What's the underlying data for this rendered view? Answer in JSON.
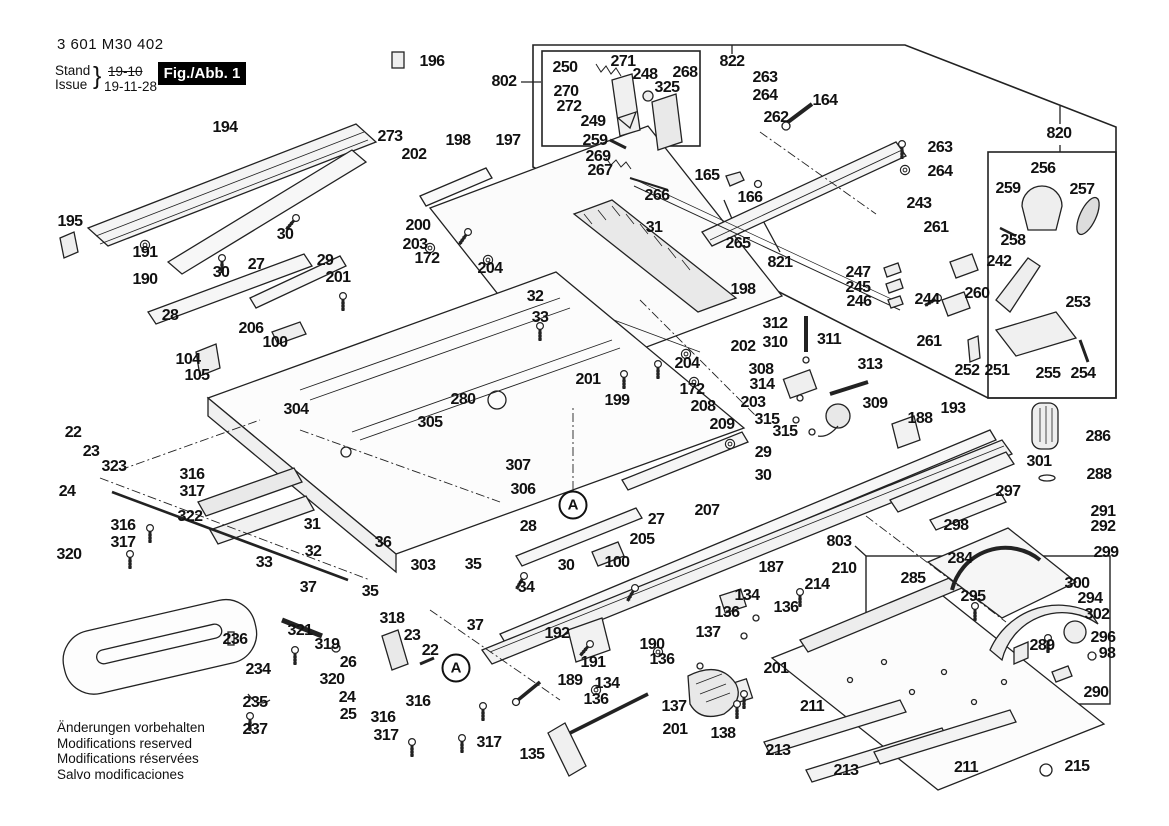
{
  "header": {
    "part_number": "3 601 M30 402",
    "stand_label": "Stand",
    "issue_label": "Issue",
    "brace": "}",
    "stand_value": "19-10",
    "issue_value": "19-11-28",
    "fig_label": "Fig./Abb. 1"
  },
  "footer": {
    "lines": [
      "Änderungen vorbehalten",
      "Modifications reserved",
      "Modifications réservées",
      "Salvo modificaciones"
    ]
  },
  "colors": {
    "ink": "#1a1a1a",
    "fig_box_bg": "#000000",
    "fig_box_text": "#ffffff",
    "paper": "#ffffff"
  },
  "circled_callouts": [
    {
      "t": "A",
      "x": 573,
      "y": 505
    },
    {
      "t": "A",
      "x": 456,
      "y": 668
    }
  ],
  "part_labels": [
    {
      "t": "196",
      "x": 432,
      "y": 62
    },
    {
      "t": "194",
      "x": 225,
      "y": 128
    },
    {
      "t": "273",
      "x": 390,
      "y": 137
    },
    {
      "t": "198",
      "x": 458,
      "y": 141
    },
    {
      "t": "202",
      "x": 414,
      "y": 155
    },
    {
      "t": "197",
      "x": 508,
      "y": 141
    },
    {
      "t": "195",
      "x": 70,
      "y": 222
    },
    {
      "t": "191",
      "x": 145,
      "y": 253
    },
    {
      "t": "190",
      "x": 145,
      "y": 280
    },
    {
      "t": "30",
      "x": 285,
      "y": 235
    },
    {
      "t": "30",
      "x": 221,
      "y": 273
    },
    {
      "t": "29",
      "x": 325,
      "y": 261
    },
    {
      "t": "27",
      "x": 256,
      "y": 265
    },
    {
      "t": "201",
      "x": 338,
      "y": 278
    },
    {
      "t": "28",
      "x": 170,
      "y": 316
    },
    {
      "t": "200",
      "x": 418,
      "y": 226
    },
    {
      "t": "203",
      "x": 415,
      "y": 245
    },
    {
      "t": "172",
      "x": 427,
      "y": 259
    },
    {
      "t": "204",
      "x": 490,
      "y": 269
    },
    {
      "t": "206",
      "x": 251,
      "y": 329
    },
    {
      "t": "100",
      "x": 275,
      "y": 343
    },
    {
      "t": "104",
      "x": 188,
      "y": 360
    },
    {
      "t": "105",
      "x": 197,
      "y": 376
    },
    {
      "t": "31",
      "x": 654,
      "y": 228
    },
    {
      "t": "32",
      "x": 535,
      "y": 297
    },
    {
      "t": "33",
      "x": 540,
      "y": 318
    },
    {
      "t": "802",
      "x": 504,
      "y": 82
    },
    {
      "t": "250",
      "x": 565,
      "y": 68
    },
    {
      "t": "271",
      "x": 623,
      "y": 62
    },
    {
      "t": "248",
      "x": 645,
      "y": 75
    },
    {
      "t": "268",
      "x": 685,
      "y": 73
    },
    {
      "t": "325",
      "x": 667,
      "y": 88
    },
    {
      "t": "270",
      "x": 566,
      "y": 92
    },
    {
      "t": "272",
      "x": 569,
      "y": 107
    },
    {
      "t": "249",
      "x": 593,
      "y": 122
    },
    {
      "t": "259",
      "x": 595,
      "y": 141
    },
    {
      "t": "269",
      "x": 598,
      "y": 157
    },
    {
      "t": "267",
      "x": 600,
      "y": 171
    },
    {
      "t": "266",
      "x": 657,
      "y": 196
    },
    {
      "t": "165",
      "x": 707,
      "y": 176
    },
    {
      "t": "166",
      "x": 750,
      "y": 198
    },
    {
      "t": "822",
      "x": 732,
      "y": 62
    },
    {
      "t": "263",
      "x": 765,
      "y": 78
    },
    {
      "t": "264",
      "x": 765,
      "y": 96
    },
    {
      "t": "262",
      "x": 776,
      "y": 118
    },
    {
      "t": "164",
      "x": 825,
      "y": 101
    },
    {
      "t": "265",
      "x": 738,
      "y": 244
    },
    {
      "t": "821",
      "x": 780,
      "y": 263
    },
    {
      "t": "820",
      "x": 1059,
      "y": 134
    },
    {
      "t": "263",
      "x": 940,
      "y": 148
    },
    {
      "t": "264",
      "x": 940,
      "y": 172
    },
    {
      "t": "243",
      "x": 919,
      "y": 204
    },
    {
      "t": "261",
      "x": 936,
      "y": 228
    },
    {
      "t": "256",
      "x": 1043,
      "y": 169
    },
    {
      "t": "259",
      "x": 1008,
      "y": 189
    },
    {
      "t": "257",
      "x": 1082,
      "y": 190
    },
    {
      "t": "258",
      "x": 1013,
      "y": 241
    },
    {
      "t": "242",
      "x": 999,
      "y": 262
    },
    {
      "t": "260",
      "x": 977,
      "y": 294
    },
    {
      "t": "244",
      "x": 927,
      "y": 300
    },
    {
      "t": "261",
      "x": 929,
      "y": 342
    },
    {
      "t": "253",
      "x": 1078,
      "y": 303
    },
    {
      "t": "252",
      "x": 967,
      "y": 371
    },
    {
      "t": "251",
      "x": 997,
      "y": 371
    },
    {
      "t": "255",
      "x": 1048,
      "y": 374
    },
    {
      "t": "254",
      "x": 1083,
      "y": 374
    },
    {
      "t": "247",
      "x": 858,
      "y": 273
    },
    {
      "t": "245",
      "x": 858,
      "y": 288
    },
    {
      "t": "246",
      "x": 859,
      "y": 302
    },
    {
      "t": "304",
      "x": 296,
      "y": 410
    },
    {
      "t": "280",
      "x": 463,
      "y": 400
    },
    {
      "t": "305",
      "x": 430,
      "y": 423
    },
    {
      "t": "307",
      "x": 518,
      "y": 466
    },
    {
      "t": "306",
      "x": 523,
      "y": 490
    },
    {
      "t": "198",
      "x": 743,
      "y": 290
    },
    {
      "t": "202",
      "x": 743,
      "y": 347
    },
    {
      "t": "201",
      "x": 588,
      "y": 380
    },
    {
      "t": "199",
      "x": 617,
      "y": 401
    },
    {
      "t": "204",
      "x": 687,
      "y": 364
    },
    {
      "t": "172",
      "x": 692,
      "y": 390
    },
    {
      "t": "203",
      "x": 753,
      "y": 403
    },
    {
      "t": "208",
      "x": 703,
      "y": 407
    },
    {
      "t": "209",
      "x": 722,
      "y": 425
    },
    {
      "t": "312",
      "x": 775,
      "y": 324
    },
    {
      "t": "310",
      "x": 775,
      "y": 343
    },
    {
      "t": "311",
      "x": 829,
      "y": 340
    },
    {
      "t": "308",
      "x": 761,
      "y": 370
    },
    {
      "t": "314",
      "x": 762,
      "y": 385
    },
    {
      "t": "313",
      "x": 870,
      "y": 365
    },
    {
      "t": "309",
      "x": 875,
      "y": 404
    },
    {
      "t": "315",
      "x": 767,
      "y": 420
    },
    {
      "t": "315",
      "x": 785,
      "y": 432
    },
    {
      "t": "188",
      "x": 920,
      "y": 419
    },
    {
      "t": "193",
      "x": 953,
      "y": 409
    },
    {
      "t": "29",
      "x": 763,
      "y": 453
    },
    {
      "t": "30",
      "x": 763,
      "y": 476
    },
    {
      "t": "27",
      "x": 656,
      "y": 520
    },
    {
      "t": "207",
      "x": 707,
      "y": 511
    },
    {
      "t": "205",
      "x": 642,
      "y": 540
    },
    {
      "t": "100",
      "x": 617,
      "y": 563
    },
    {
      "t": "30",
      "x": 566,
      "y": 566
    },
    {
      "t": "28",
      "x": 528,
      "y": 527
    },
    {
      "t": "187",
      "x": 771,
      "y": 568
    },
    {
      "t": "22",
      "x": 73,
      "y": 433
    },
    {
      "t": "23",
      "x": 91,
      "y": 452
    },
    {
      "t": "323",
      "x": 114,
      "y": 467
    },
    {
      "t": "316",
      "x": 192,
      "y": 475
    },
    {
      "t": "317",
      "x": 192,
      "y": 492
    },
    {
      "t": "24",
      "x": 67,
      "y": 492
    },
    {
      "t": "316",
      "x": 123,
      "y": 526
    },
    {
      "t": "317",
      "x": 123,
      "y": 543
    },
    {
      "t": "320",
      "x": 69,
      "y": 555
    },
    {
      "t": "322",
      "x": 190,
      "y": 517
    },
    {
      "t": "31",
      "x": 312,
      "y": 525
    },
    {
      "t": "32",
      "x": 313,
      "y": 552
    },
    {
      "t": "33",
      "x": 264,
      "y": 563
    },
    {
      "t": "36",
      "x": 383,
      "y": 543
    },
    {
      "t": "35",
      "x": 370,
      "y": 592
    },
    {
      "t": "37",
      "x": 308,
      "y": 588
    },
    {
      "t": "303",
      "x": 423,
      "y": 566
    },
    {
      "t": "35",
      "x": 473,
      "y": 565
    },
    {
      "t": "34",
      "x": 526,
      "y": 588
    },
    {
      "t": "37",
      "x": 475,
      "y": 626
    },
    {
      "t": "318",
      "x": 392,
      "y": 619
    },
    {
      "t": "23",
      "x": 412,
      "y": 636
    },
    {
      "t": "22",
      "x": 430,
      "y": 651
    },
    {
      "t": "321",
      "x": 300,
      "y": 631
    },
    {
      "t": "319",
      "x": 327,
      "y": 645
    },
    {
      "t": "26",
      "x": 348,
      "y": 663
    },
    {
      "t": "320",
      "x": 332,
      "y": 680
    },
    {
      "t": "24",
      "x": 347,
      "y": 698
    },
    {
      "t": "25",
      "x": 348,
      "y": 715
    },
    {
      "t": "316",
      "x": 383,
      "y": 718
    },
    {
      "t": "317",
      "x": 386,
      "y": 736
    },
    {
      "t": "236",
      "x": 235,
      "y": 640
    },
    {
      "t": "234",
      "x": 258,
      "y": 670
    },
    {
      "t": "235",
      "x": 255,
      "y": 703
    },
    {
      "t": "237",
      "x": 255,
      "y": 730
    },
    {
      "t": "192",
      "x": 557,
      "y": 634
    },
    {
      "t": "190",
      "x": 652,
      "y": 645
    },
    {
      "t": "191",
      "x": 593,
      "y": 663
    },
    {
      "t": "189",
      "x": 570,
      "y": 681
    },
    {
      "t": "134",
      "x": 747,
      "y": 596
    },
    {
      "t": "136",
      "x": 727,
      "y": 613
    },
    {
      "t": "137",
      "x": 708,
      "y": 633
    },
    {
      "t": "136",
      "x": 662,
      "y": 660
    },
    {
      "t": "134",
      "x": 607,
      "y": 684
    },
    {
      "t": "136",
      "x": 596,
      "y": 700
    },
    {
      "t": "137",
      "x": 674,
      "y": 707
    },
    {
      "t": "201",
      "x": 675,
      "y": 730
    },
    {
      "t": "138",
      "x": 723,
      "y": 734
    },
    {
      "t": "135",
      "x": 532,
      "y": 755
    },
    {
      "t": "316",
      "x": 418,
      "y": 702
    },
    {
      "t": "317",
      "x": 489,
      "y": 743
    },
    {
      "t": "803",
      "x": 839,
      "y": 542
    },
    {
      "t": "210",
      "x": 844,
      "y": 569
    },
    {
      "t": "214",
      "x": 817,
      "y": 585
    },
    {
      "t": "285",
      "x": 913,
      "y": 579
    },
    {
      "t": "295",
      "x": 973,
      "y": 597
    },
    {
      "t": "294",
      "x": 1090,
      "y": 599
    },
    {
      "t": "300",
      "x": 1077,
      "y": 584
    },
    {
      "t": "302",
      "x": 1097,
      "y": 615
    },
    {
      "t": "289",
      "x": 1042,
      "y": 646
    },
    {
      "t": "296",
      "x": 1103,
      "y": 638
    },
    {
      "t": "98",
      "x": 1107,
      "y": 654
    },
    {
      "t": "290",
      "x": 1096,
      "y": 693
    },
    {
      "t": "136",
      "x": 786,
      "y": 608
    },
    {
      "t": "201",
      "x": 776,
      "y": 669
    },
    {
      "t": "211",
      "x": 812,
      "y": 707
    },
    {
      "t": "213",
      "x": 778,
      "y": 751
    },
    {
      "t": "213",
      "x": 846,
      "y": 771
    },
    {
      "t": "211",
      "x": 966,
      "y": 768
    },
    {
      "t": "215",
      "x": 1077,
      "y": 767
    },
    {
      "t": "301",
      "x": 1039,
      "y": 462
    },
    {
      "t": "286",
      "x": 1098,
      "y": 437
    },
    {
      "t": "288",
      "x": 1099,
      "y": 475
    },
    {
      "t": "297",
      "x": 1008,
      "y": 492
    },
    {
      "t": "298",
      "x": 956,
      "y": 526
    },
    {
      "t": "291",
      "x": 1103,
      "y": 512
    },
    {
      "t": "292",
      "x": 1103,
      "y": 527
    },
    {
      "t": "284",
      "x": 960,
      "y": 559
    },
    {
      "t": "299",
      "x": 1106,
      "y": 553
    }
  ]
}
